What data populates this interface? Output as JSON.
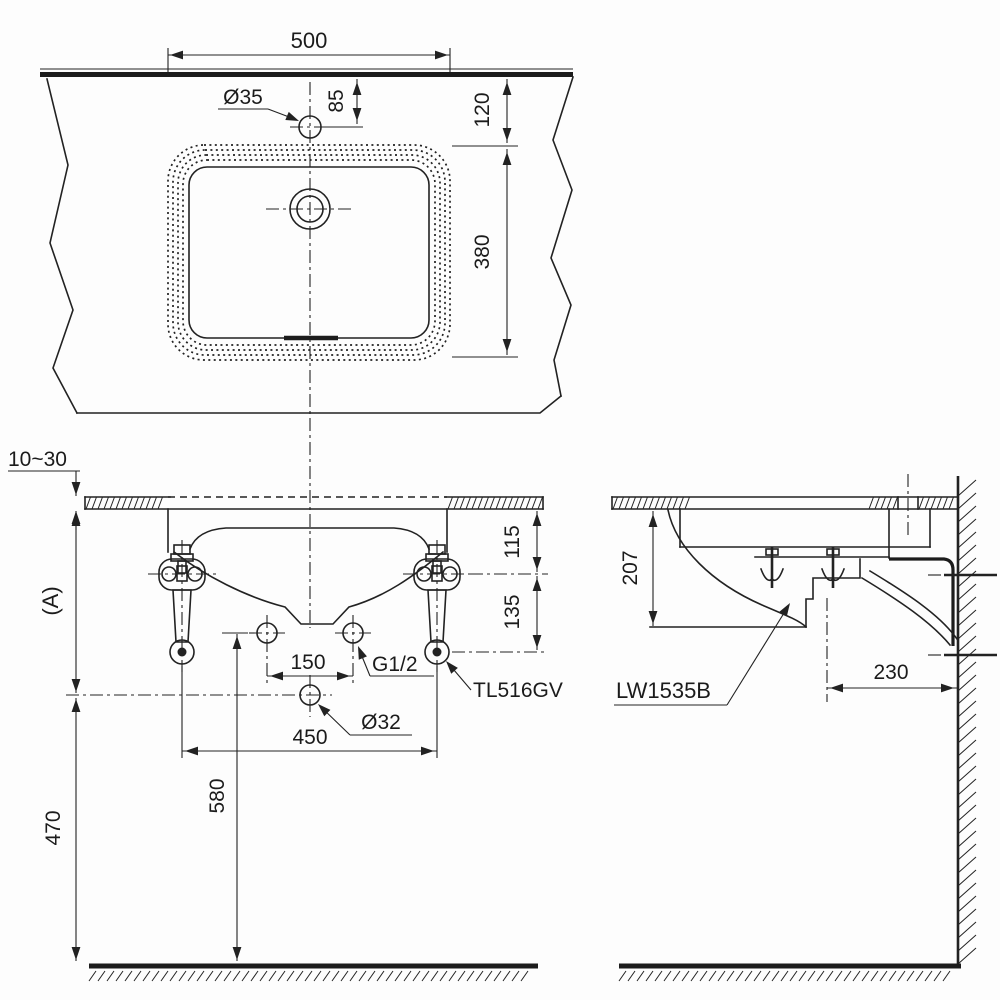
{
  "drawing": {
    "product_code": "LW1535B",
    "accessory_code": "TL516GV",
    "colors": {
      "line": "#222222",
      "background": "#fdfdfd"
    },
    "top_view": {
      "dim_basin_width": "500",
      "faucet_hole_label": "Ø35",
      "dim_faucet_setback": "85",
      "dim_rim_setback": "120",
      "dim_basin_depth": "380"
    },
    "front_view": {
      "dim_counter_thickness": "10~30",
      "dim_height_reference": "(A)",
      "dim_counter_to_holes": "115",
      "dim_holes_to_bracket": "135",
      "dim_supply_hole_pitch": "150",
      "supply_thread_label": "G1/2",
      "bracket_label": "TL516GV",
      "drain_hole_label": "Ø32",
      "dim_bracket_pitch": "450",
      "dim_holes_to_floor": "580",
      "dim_ref_to_floor": "470"
    },
    "side_view": {
      "dim_counter_to_bottom": "207",
      "product_label": "LW1535B",
      "dim_drain_to_wall": "230"
    }
  }
}
